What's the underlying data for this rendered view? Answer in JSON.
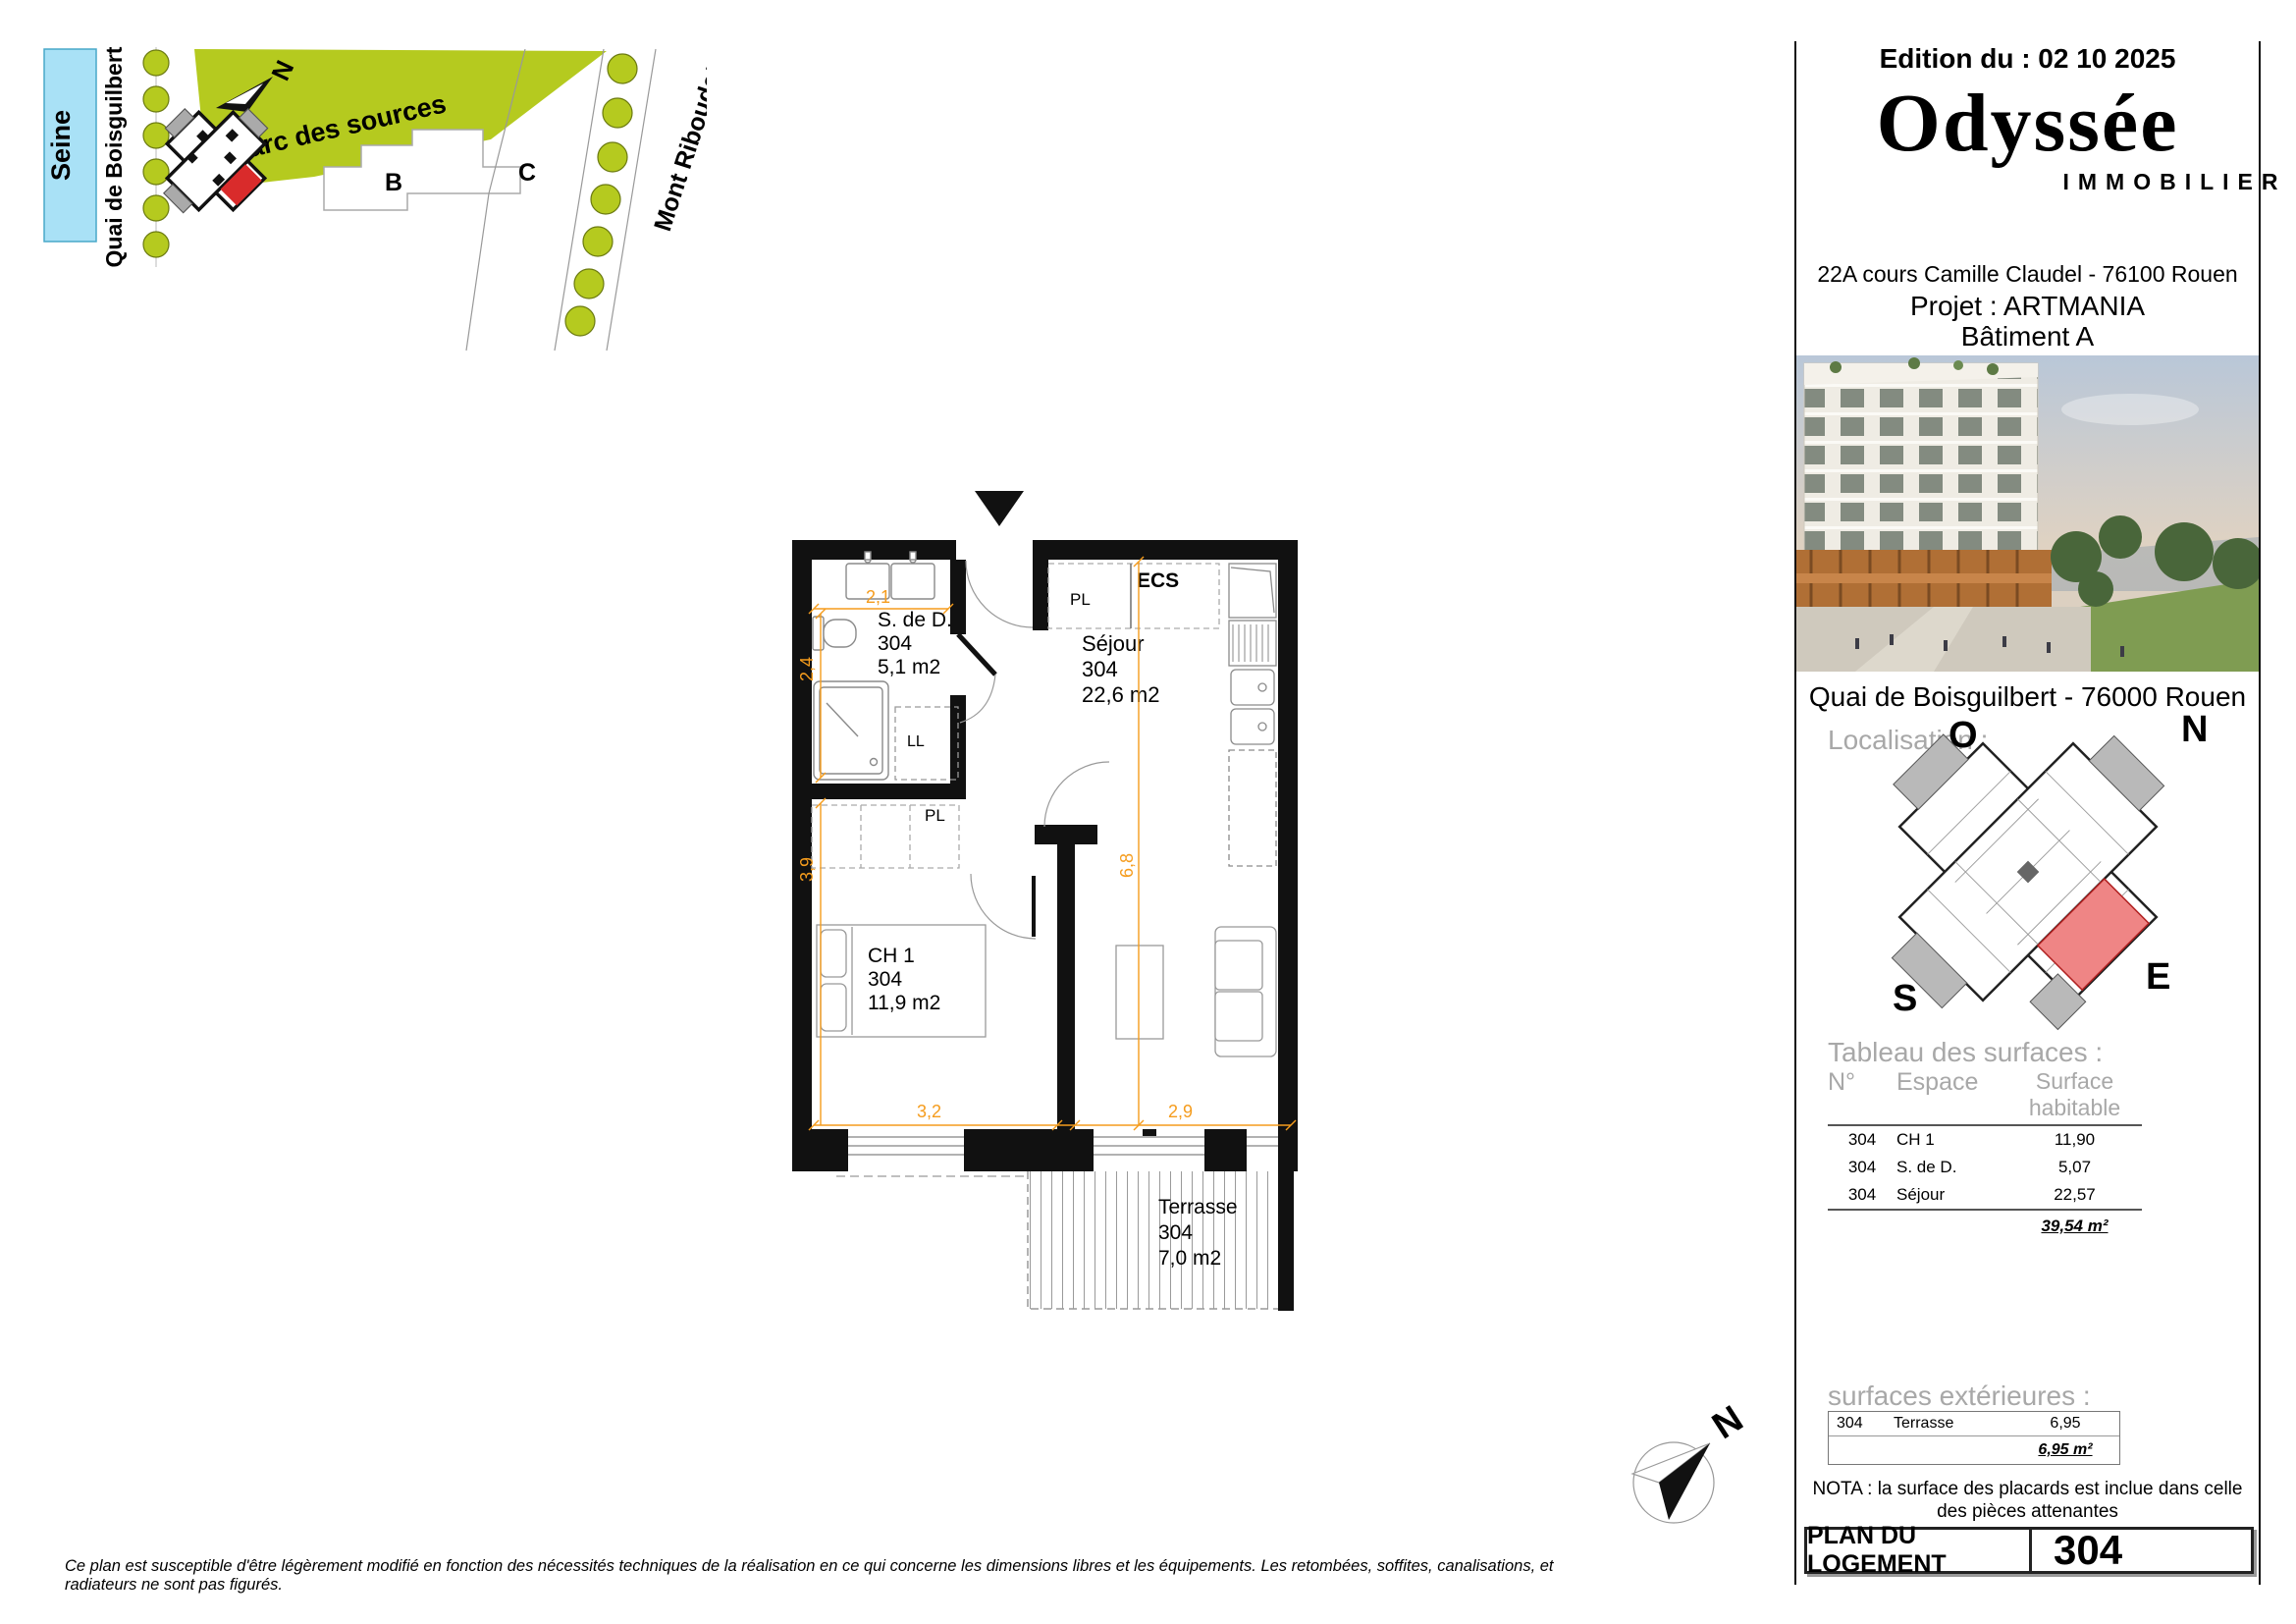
{
  "site": {
    "seine": "Seine",
    "quai": "Quai de Boisguilbert",
    "parc": "Parc des sources",
    "north": "N",
    "building_b": "B",
    "building_c": "C",
    "mont": "Mont Riboudet"
  },
  "plan": {
    "rooms": {
      "sdd": {
        "name": "S. de D.",
        "num": "304",
        "area": "5,1 m2"
      },
      "sejour": {
        "name": "Séjour",
        "num": "304",
        "area": "22,6 m2"
      },
      "ch1": {
        "name": "CH 1",
        "num": "304",
        "area": "11,9 m2"
      },
      "terrasse": {
        "name": "Terrasse",
        "num": "304",
        "area": "7,0 m2"
      }
    },
    "labels": {
      "pl_sejour": "PL",
      "ll": "LL",
      "pl_hall": "PL",
      "ecs": "ECS"
    },
    "dims": {
      "d21": "2,1",
      "d24": "2,4",
      "d39": "3,9",
      "d32": "3,2",
      "d29": "2,9",
      "d68": "6,8"
    }
  },
  "panel": {
    "edition": "Edition du : 02 10 2025",
    "logo": "Odyssée",
    "logo_sub": "IMMOBILIER",
    "address": "22A cours Camille Claudel - 76100 Rouen",
    "project": "Projet : ARTMANIA",
    "building": "Bâtiment A",
    "photo_caption": "Quai de Boisguilbert - 76000 Rouen",
    "localisation": "Localisation :",
    "compass": {
      "o": "O",
      "n": "N",
      "s": "S",
      "e": "E"
    },
    "surfaces": {
      "title": "Tableau des surfaces :",
      "headers": [
        "N°",
        "Espace",
        "Surface habitable"
      ],
      "rows": [
        [
          "304",
          "CH 1",
          "11,90"
        ],
        [
          "304",
          "S. de D.",
          "5,07"
        ],
        [
          "304",
          "Séjour",
          "22,57"
        ]
      ],
      "total": "39,54 m²"
    },
    "exterieures": {
      "title": "surfaces extérieures :",
      "row": [
        "304",
        "Terrasse",
        "6,95"
      ],
      "total": "6,95 m²"
    },
    "nota_line1": "NOTA : la surface des placards est inclue dans celle",
    "nota_line2": "des pièces attenantes",
    "footer": {
      "label": "PLAN DU LOGEMENT",
      "number": "304"
    }
  },
  "compass_n": "N",
  "disclaimer": "Ce plan est susceptible d'être légèrement modifié en fonction des nécessités techniques de la réalisation en ce qui concerne les dimensions libres et les équipements. Les retombées, soffites, canalisations, et radiateurs ne sont pas figurés.",
  "colors": {
    "tree_green": "#b5ca1f",
    "seine_blue": "#a9e1f6",
    "dim_orange": "#f59c1d",
    "unit_red": "#ef8585",
    "wall_black": "#111111"
  }
}
